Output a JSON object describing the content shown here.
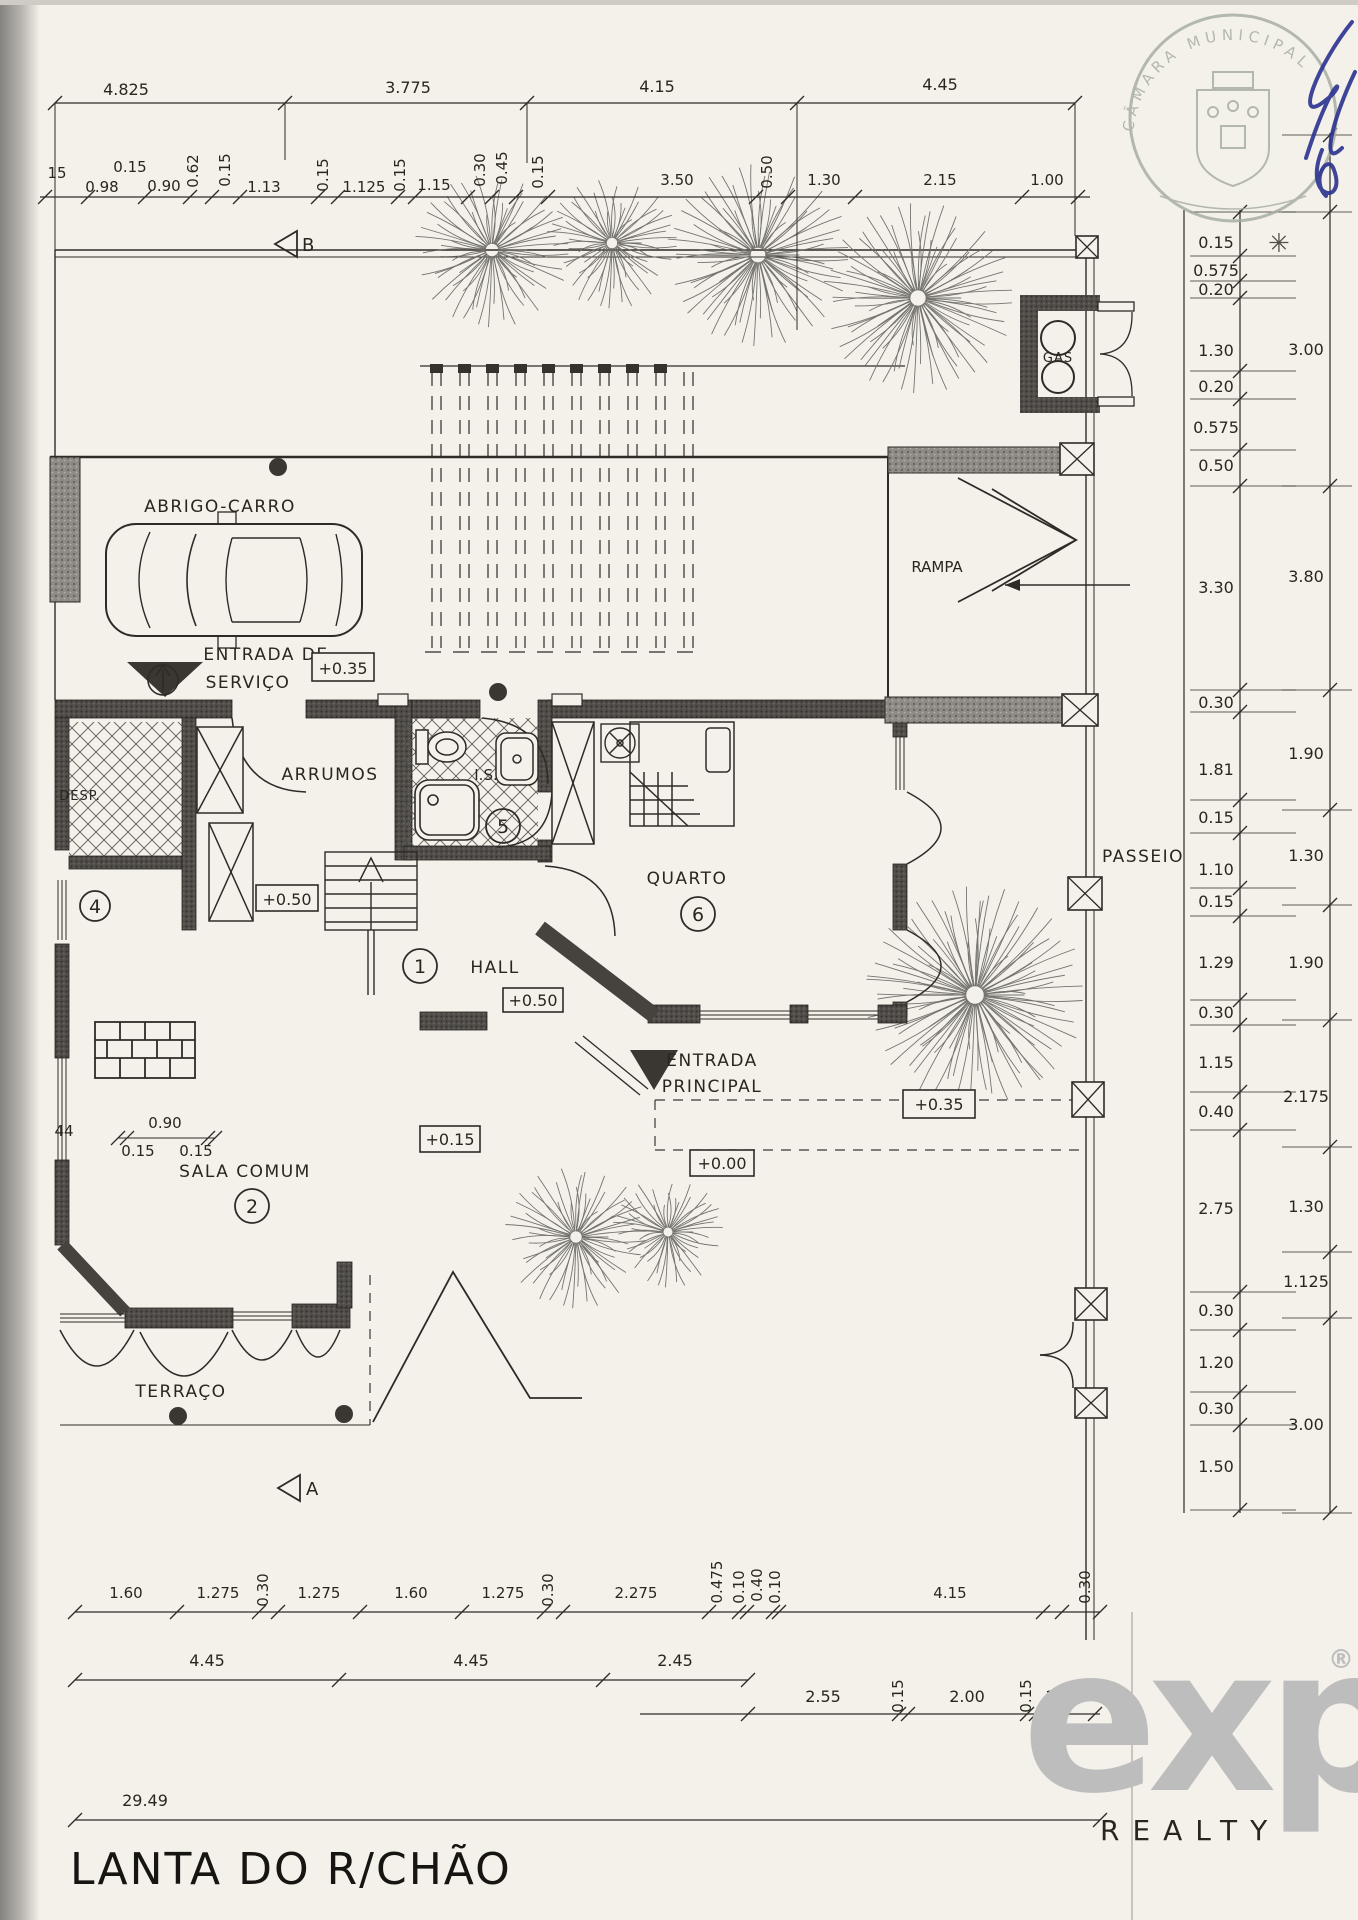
{
  "title_block": {
    "title": "LANTA DO R/CHÃO"
  },
  "stamp": {
    "text": "CÂMARA MUNICIPAL",
    "mark": "✳"
  },
  "watermark": {
    "brand": "exp",
    "reg": "®",
    "subtitle": "REALTY"
  },
  "section_markers": {
    "top": "B",
    "bottom": "A"
  },
  "rooms": {
    "carport": "ABRIGO-CARRO",
    "storage": "ARRUMOS",
    "wc": "I.S.",
    "bedroom": "QUARTO",
    "hall": "HALL",
    "living": "SALA COMUM",
    "terrace": "TERRAÇO",
    "pantry": "DESP.",
    "ramp": "RAMPA",
    "sidewalk": "PASSEIO",
    "gas": "GAS"
  },
  "entrances": {
    "service_line1": "ENTRADA DE",
    "service_line2": "SERVIÇO",
    "main_line1": "ENTRADA",
    "main_line2": "PRINCIPAL"
  },
  "room_numbers": {
    "hall": "1",
    "living": "2",
    "pantry": "4",
    "wc": "5",
    "bedroom": "6"
  },
  "elevations": {
    "service": "+0.35",
    "stairs": "+0.50",
    "hall": "+0.50",
    "living": "+0.15",
    "entry": "+0.00",
    "passeio": "+0.35"
  },
  "dims": {
    "top_row1": [
      "4.825",
      "3.775",
      "4.15",
      "4.45"
    ],
    "top_row2_h": [
      "15",
      "0.15",
      "0.98",
      "0.90",
      "1.13",
      "1.125",
      "1.15",
      "3.50",
      "1.30",
      "2.15",
      "1.00"
    ],
    "top_row2_v": [
      "0.62",
      "0.15",
      "0.15",
      "0.15",
      "0.30",
      "0.45",
      "0.15",
      "0.50"
    ],
    "right_col1": [
      "0.15",
      "0.575",
      "0.20",
      "1.30",
      "0.20",
      "0.575",
      "0.50",
      "3.30",
      "0.30",
      "1.81",
      "0.15",
      "1.10",
      "0.15",
      "1.29",
      "0.30",
      "1.15",
      "0.40",
      "2.75",
      "0.30",
      "1.20",
      "0.30",
      "1.50"
    ],
    "right_col2": [
      "3.00",
      "3.80",
      "1.90",
      "1.30",
      "1.90",
      "2.175",
      "1.30",
      "1.125",
      "3.00"
    ],
    "bottom_row1_h": [
      "1.60",
      "1.275",
      "1.275",
      "1.60",
      "1.275",
      "2.275",
      "4.15"
    ],
    "bottom_row1_v": [
      "0.30",
      "0.30",
      "0.475",
      "0.10",
      "0.40",
      "0.10",
      "0.30"
    ],
    "bottom_row2a": [
      "4.45",
      "4.45",
      "2.45"
    ],
    "bottom_row2b": [
      "2.55",
      "2.00",
      "1.00"
    ],
    "bottom_row2_v": [
      "0.15",
      "0.15"
    ],
    "sala_dims": [
      "44",
      "0.90",
      "0.15",
      "0.15"
    ],
    "total": "29.49"
  }
}
